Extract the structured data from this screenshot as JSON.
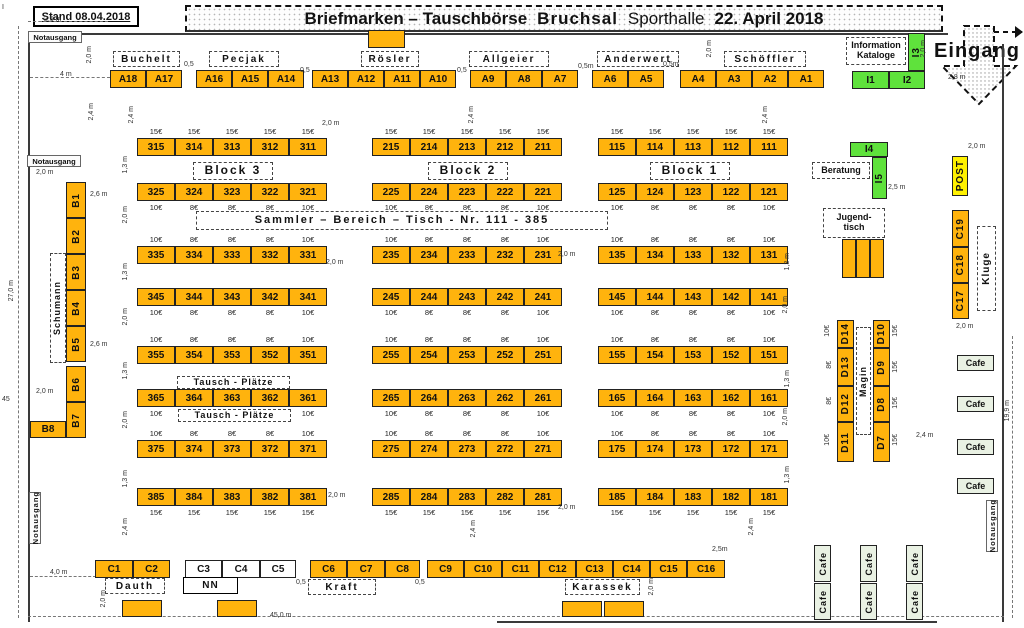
{
  "header": {
    "stand": "Stand 08.04.2018",
    "title_1": "Briefmarken – Tauschbörse",
    "title_2": "Bruchsal",
    "title_3": "Sporthalle",
    "title_4": "22. April 2018"
  },
  "entrance": {
    "label": "Eingang"
  },
  "colors": {
    "orange": "#FFB30D",
    "green": "#5FE23C",
    "yellow": "#FFF100",
    "cafe": "#E9F1E3",
    "white": "#FFFFFF"
  },
  "grid": {
    "col_x": [
      137,
      372,
      598
    ],
    "tw": 38,
    "th": 18,
    "rows": [
      {
        "y": 138,
        "pp": "above",
        "prices": [
          "15€",
          "15€",
          "15€",
          "15€",
          "15€"
        ],
        "cells": [
          [
            "315",
            "314",
            "313",
            "312",
            "311"
          ],
          [
            "215",
            "214",
            "213",
            "212",
            "211"
          ],
          [
            "115",
            "114",
            "113",
            "112",
            "111"
          ]
        ]
      },
      {
        "y": 183,
        "pp": "below",
        "prices": [
          "10€",
          "8€",
          "8€",
          "8€",
          "10€"
        ],
        "cells": [
          [
            "325",
            "324",
            "323",
            "322",
            "321"
          ],
          [
            "225",
            "224",
            "223",
            "222",
            "221"
          ],
          [
            "125",
            "124",
            "123",
            "122",
            "121"
          ]
        ]
      },
      {
        "y": 246,
        "pp": "above",
        "prices": [
          "10€",
          "8€",
          "8€",
          "8€",
          "10€"
        ],
        "cells": [
          [
            "335",
            "334",
            "333",
            "332",
            "331"
          ],
          [
            "235",
            "234",
            "233",
            "232",
            "231"
          ],
          [
            "135",
            "134",
            "133",
            "132",
            "131"
          ]
        ]
      },
      {
        "y": 288,
        "pp": "below",
        "prices": [
          "10€",
          "8€",
          "8€",
          "8€",
          "10€"
        ],
        "cells": [
          [
            "345",
            "344",
            "343",
            "342",
            "341"
          ],
          [
            "245",
            "244",
            "243",
            "242",
            "241"
          ],
          [
            "145",
            "144",
            "143",
            "142",
            "141"
          ]
        ]
      },
      {
        "y": 346,
        "pp": "above",
        "prices": [
          "10€",
          "8€",
          "8€",
          "8€",
          "10€"
        ],
        "cells": [
          [
            "355",
            "354",
            "353",
            "352",
            "351"
          ],
          [
            "255",
            "254",
            "253",
            "252",
            "251"
          ],
          [
            "155",
            "154",
            "153",
            "152",
            "151"
          ]
        ]
      },
      {
        "y": 389,
        "pp": "below",
        "prices": [
          "10€",
          "8€",
          "8€",
          "8€",
          "10€"
        ],
        "cells": [
          [
            "365",
            "364",
            "363",
            "362",
            "361"
          ],
          [
            "265",
            "264",
            "263",
            "262",
            "261"
          ],
          [
            "165",
            "164",
            "163",
            "162",
            "161"
          ]
        ]
      },
      {
        "y": 440,
        "pp": "above",
        "prices": [
          "10€",
          "8€",
          "8€",
          "8€",
          "10€"
        ],
        "cells": [
          [
            "375",
            "374",
            "373",
            "372",
            "371"
          ],
          [
            "275",
            "274",
            "273",
            "272",
            "271"
          ],
          [
            "175",
            "174",
            "173",
            "172",
            "171"
          ]
        ]
      },
      {
        "y": 488,
        "pp": "below",
        "prices": [
          "15€",
          "15€",
          "15€",
          "15€",
          "15€"
        ],
        "cells": [
          [
            "385",
            "384",
            "383",
            "382",
            "381"
          ],
          [
            "285",
            "284",
            "283",
            "282",
            "281"
          ],
          [
            "185",
            "184",
            "183",
            "182",
            "181"
          ]
        ]
      }
    ]
  },
  "tables": [
    {
      "id": "A18",
      "x": 110,
      "y": 70
    },
    {
      "id": "A17",
      "x": 146,
      "y": 70
    },
    {
      "id": "A16",
      "x": 196,
      "y": 70
    },
    {
      "id": "A15",
      "x": 232,
      "y": 70
    },
    {
      "id": "A14",
      "x": 268,
      "y": 70
    },
    {
      "id": "A13",
      "x": 312,
      "y": 70
    },
    {
      "id": "A12",
      "x": 348,
      "y": 70
    },
    {
      "id": "A11",
      "x": 384,
      "y": 70
    },
    {
      "id": "A10",
      "x": 420,
      "y": 70
    },
    {
      "id": "A9",
      "x": 470,
      "y": 70
    },
    {
      "id": "A8",
      "x": 506,
      "y": 70
    },
    {
      "id": "A7",
      "x": 542,
      "y": 70
    },
    {
      "id": "A6",
      "x": 592,
      "y": 70
    },
    {
      "id": "A5",
      "x": 628,
      "y": 70
    },
    {
      "id": "A4",
      "x": 680,
      "y": 70
    },
    {
      "id": "A3",
      "x": 716,
      "y": 70
    },
    {
      "id": "A2",
      "x": 752,
      "y": 70
    },
    {
      "id": "A1",
      "x": 788,
      "y": 70
    },
    {
      "id": "",
      "x": 368,
      "y": 30,
      "w": 37,
      "h": 18
    },
    {
      "id": "B1",
      "x": 66,
      "y": 182,
      "w": 20,
      "h": 36,
      "v": 1
    },
    {
      "id": "B2",
      "x": 66,
      "y": 218,
      "w": 20,
      "h": 36,
      "v": 1
    },
    {
      "id": "B3",
      "x": 66,
      "y": 254,
      "w": 20,
      "h": 36,
      "v": 1
    },
    {
      "id": "B4",
      "x": 66,
      "y": 290,
      "w": 20,
      "h": 36,
      "v": 1
    },
    {
      "id": "B5",
      "x": 66,
      "y": 326,
      "w": 20,
      "h": 36,
      "v": 1
    },
    {
      "id": "B6",
      "x": 66,
      "y": 366,
      "w": 20,
      "h": 36,
      "v": 1
    },
    {
      "id": "B7",
      "x": 66,
      "y": 402,
      "w": 20,
      "h": 36,
      "v": 1
    },
    {
      "id": "B8",
      "x": 30,
      "y": 421,
      "w": 36,
      "h": 17
    },
    {
      "id": "C1",
      "x": 95,
      "y": 560,
      "w": 38
    },
    {
      "id": "C2",
      "x": 133,
      "y": 560,
      "w": 37
    },
    {
      "id": "C3",
      "x": 185,
      "y": 560,
      "w": 37,
      "f": "white"
    },
    {
      "id": "C4",
      "x": 222,
      "y": 560,
      "w": 38,
      "f": "white"
    },
    {
      "id": "C5",
      "x": 260,
      "y": 560,
      "w": 36,
      "f": "white"
    },
    {
      "id": "C6",
      "x": 310,
      "y": 560,
      "w": 37
    },
    {
      "id": "C7",
      "x": 347,
      "y": 560,
      "w": 38
    },
    {
      "id": "C8",
      "x": 385,
      "y": 560,
      "w": 35
    },
    {
      "id": "C9",
      "x": 427,
      "y": 560,
      "w": 37
    },
    {
      "id": "C10",
      "x": 464,
      "y": 560,
      "w": 38
    },
    {
      "id": "C11",
      "x": 502,
      "y": 560,
      "w": 37
    },
    {
      "id": "C12",
      "x": 539,
      "y": 560,
      "w": 37
    },
    {
      "id": "C13",
      "x": 576,
      "y": 560,
      "w": 37
    },
    {
      "id": "C14",
      "x": 613,
      "y": 560,
      "w": 37
    },
    {
      "id": "C15",
      "x": 650,
      "y": 560,
      "w": 37
    },
    {
      "id": "C16",
      "x": 687,
      "y": 560,
      "w": 38
    },
    {
      "id": "C19",
      "x": 952,
      "y": 210,
      "w": 17,
      "h": 37,
      "v": 1
    },
    {
      "id": "C18",
      "x": 952,
      "y": 247,
      "w": 17,
      "h": 36,
      "v": 1
    },
    {
      "id": "C17",
      "x": 952,
      "y": 283,
      "w": 17,
      "h": 36,
      "v": 1
    },
    {
      "id": "POST",
      "x": 952,
      "y": 156,
      "w": 16,
      "h": 40,
      "f": "yellow",
      "v": 1
    },
    {
      "id": "I1",
      "x": 852,
      "y": 71,
      "w": 37,
      "f": "green"
    },
    {
      "id": "I2",
      "x": 889,
      "y": 71,
      "w": 36,
      "f": "green"
    },
    {
      "id": "I3",
      "x": 908,
      "y": 33,
      "w": 17,
      "h": 38,
      "f": "green",
      "v": 1
    },
    {
      "id": "I4",
      "x": 850,
      "y": 142,
      "w": 38,
      "h": 15,
      "f": "green"
    },
    {
      "id": "I5",
      "x": 872,
      "y": 157,
      "w": 15,
      "h": 42,
      "f": "green",
      "v": 1
    },
    {
      "id": "",
      "x": 842,
      "y": 239,
      "w": 14,
      "h": 39
    },
    {
      "id": "",
      "x": 856,
      "y": 239,
      "w": 14,
      "h": 39
    },
    {
      "id": "",
      "x": 870,
      "y": 239,
      "w": 14,
      "h": 39
    },
    {
      "id": "D14",
      "x": 837,
      "y": 320,
      "w": 17,
      "h": 28,
      "v": 1
    },
    {
      "id": "D13",
      "x": 837,
      "y": 348,
      "w": 17,
      "h": 38,
      "v": 1
    },
    {
      "id": "D12",
      "x": 837,
      "y": 386,
      "w": 17,
      "h": 36,
      "v": 1
    },
    {
      "id": "D11",
      "x": 837,
      "y": 422,
      "w": 17,
      "h": 40,
      "v": 1
    },
    {
      "id": "D10",
      "x": 873,
      "y": 320,
      "w": 17,
      "h": 28,
      "v": 1
    },
    {
      "id": "D9",
      "x": 873,
      "y": 348,
      "w": 17,
      "h": 38,
      "v": 1
    },
    {
      "id": "D8",
      "x": 873,
      "y": 386,
      "w": 17,
      "h": 36,
      "v": 1
    },
    {
      "id": "D7",
      "x": 873,
      "y": 422,
      "w": 17,
      "h": 40,
      "v": 1
    },
    {
      "id": "",
      "x": 122,
      "y": 600,
      "w": 40,
      "h": 17
    },
    {
      "id": "",
      "x": 217,
      "y": 600,
      "w": 40,
      "h": 17
    },
    {
      "id": "",
      "x": 562,
      "y": 601,
      "w": 40,
      "h": 16
    },
    {
      "id": "",
      "x": 604,
      "y": 601,
      "w": 40,
      "h": 16
    }
  ],
  "cafes": [
    {
      "t": "Cafe",
      "x": 957,
      "y": 355,
      "w": 37,
      "h": 16
    },
    {
      "t": "Cafe",
      "x": 957,
      "y": 396,
      "w": 37,
      "h": 16
    },
    {
      "t": "Cafe",
      "x": 957,
      "y": 439,
      "w": 37,
      "h": 16
    },
    {
      "t": "Cafe",
      "x": 957,
      "y": 478,
      "w": 37,
      "h": 16
    },
    {
      "t": "Cafe",
      "x": 814,
      "y": 545,
      "w": 17,
      "h": 37,
      "v": 1
    },
    {
      "t": "Cafe",
      "x": 814,
      "y": 583,
      "w": 17,
      "h": 37,
      "v": 1
    },
    {
      "t": "Cafe",
      "x": 860,
      "y": 545,
      "w": 17,
      "h": 37,
      "v": 1
    },
    {
      "t": "Cafe",
      "x": 860,
      "y": 583,
      "w": 17,
      "h": 37,
      "v": 1
    },
    {
      "t": "Cafe",
      "x": 906,
      "y": 545,
      "w": 17,
      "h": 37,
      "v": 1
    },
    {
      "t": "Cafe",
      "x": 906,
      "y": 583,
      "w": 17,
      "h": 37,
      "v": 1
    }
  ],
  "labels": [
    {
      "t": "Buchelt",
      "x": 113,
      "y": 51,
      "w": 67,
      "h": 16
    },
    {
      "t": "Pecjak",
      "x": 209,
      "y": 51,
      "w": 70,
      "h": 16
    },
    {
      "t": "Rösler",
      "x": 361,
      "y": 51,
      "w": 58,
      "h": 16
    },
    {
      "t": "Allgeier",
      "x": 469,
      "y": 51,
      "w": 80,
      "h": 16
    },
    {
      "t": "Anderwert",
      "x": 597,
      "y": 51,
      "w": 82,
      "h": 16
    },
    {
      "t": "Schöffler",
      "x": 724,
      "y": 51,
      "w": 82,
      "h": 16
    },
    {
      "t": "Block 3",
      "x": 193,
      "y": 162,
      "w": 80,
      "h": 18,
      "fs": 12
    },
    {
      "t": "Block 2",
      "x": 428,
      "y": 162,
      "w": 80,
      "h": 18,
      "fs": 12
    },
    {
      "t": "Block 1",
      "x": 650,
      "y": 162,
      "w": 80,
      "h": 18,
      "fs": 12
    },
    {
      "t": "Sammler – Bereich  –  Tisch - Nr. 111 - 385",
      "x": 196,
      "y": 211,
      "w": 412,
      "h": 19,
      "fs": 11
    },
    {
      "t": "Tausch - Plätze",
      "x": 177,
      "y": 376,
      "w": 113,
      "h": 13,
      "fs": 9,
      "ls": 1
    },
    {
      "t": "Tausch - Plätze",
      "x": 178,
      "y": 409,
      "w": 113,
      "h": 13,
      "fs": 9,
      "ls": 1
    },
    {
      "t": "Schumann",
      "x": 50,
      "y": 253,
      "w": 16,
      "h": 110,
      "v": 1,
      "fs": 9
    },
    {
      "t": "Kluge",
      "x": 977,
      "y": 226,
      "w": 19,
      "h": 85,
      "v": 1,
      "fs": 10
    },
    {
      "t": "Magin",
      "x": 856,
      "y": 327,
      "w": 15,
      "h": 108,
      "v": 1,
      "fs": 9
    },
    {
      "t": "Jugend-\ntisch",
      "x": 823,
      "y": 208,
      "w": 62,
      "h": 30,
      "fs": 9,
      "ls": 0
    },
    {
      "t": "Information\nKataloge",
      "x": 846,
      "y": 37,
      "w": 60,
      "h": 28,
      "fs": 9,
      "ls": 0
    },
    {
      "t": "Beratung",
      "x": 812,
      "y": 162,
      "w": 58,
      "h": 17,
      "fs": 9,
      "ls": 0
    },
    {
      "t": "Dauth",
      "x": 105,
      "y": 578,
      "w": 60,
      "h": 16
    },
    {
      "t": "NN",
      "x": 183,
      "y": 577,
      "w": 55,
      "h": 17,
      "solid": 1
    },
    {
      "t": "Kraft",
      "x": 308,
      "y": 579,
      "w": 68,
      "h": 16
    },
    {
      "t": "Karassek",
      "x": 565,
      "y": 579,
      "w": 75,
      "h": 16
    }
  ],
  "exits": [
    {
      "t": "Notausgang",
      "x": 28,
      "y": 31,
      "w": 54,
      "h": 12
    },
    {
      "t": "Notausgang",
      "x": 27,
      "y": 155,
      "w": 54,
      "h": 12
    },
    {
      "t": "Notausgang",
      "x": 29,
      "y": 492,
      "w": 12,
      "h": 52,
      "v": 1
    },
    {
      "t": "Notausgang",
      "x": 986,
      "y": 500,
      "w": 12,
      "h": 52,
      "v": 1
    }
  ],
  "d_prices": [
    {
      "t": "10€",
      "x": 824,
      "y": 325,
      "r": 1
    },
    {
      "t": "8€",
      "x": 826,
      "y": 361,
      "r": 1
    },
    {
      "t": "8€",
      "x": 826,
      "y": 397,
      "r": 1
    },
    {
      "t": "10€",
      "x": 824,
      "y": 434,
      "r": 1
    },
    {
      "t": "15€",
      "x": 892,
      "y": 325,
      "r": 1
    },
    {
      "t": "15€",
      "x": 892,
      "y": 361,
      "r": 1
    },
    {
      "t": "15€",
      "x": 892,
      "y": 397,
      "r": 1
    },
    {
      "t": "15€",
      "x": 892,
      "y": 434,
      "r": 1
    }
  ],
  "dims": [
    {
      "t": "I",
      "x": 2,
      "y": 4
    },
    {
      "t": "2,5 m",
      "x": 44,
      "y": 16
    },
    {
      "t": "4 m",
      "x": 60,
      "y": 71
    },
    {
      "t": "2,0 m",
      "x": 86,
      "y": 46,
      "r": 1
    },
    {
      "t": "2,4 m",
      "x": 88,
      "y": 103,
      "r": 1
    },
    {
      "t": "27,0 m",
      "x": 8,
      "y": 280,
      "r": 1
    },
    {
      "t": "45",
      "x": 2,
      "y": 396
    },
    {
      "t": "2,0 m",
      "x": 36,
      "y": 169
    },
    {
      "t": "2,6 m",
      "x": 90,
      "y": 191
    },
    {
      "t": "2,6 m",
      "x": 90,
      "y": 341
    },
    {
      "t": "2,0 m",
      "x": 36,
      "y": 388
    },
    {
      "t": "4,0 m",
      "x": 50,
      "y": 569
    },
    {
      "t": "45,0 m",
      "x": 270,
      "y": 612
    },
    {
      "t": "2,4 m",
      "x": 128,
      "y": 106,
      "r": 1
    },
    {
      "t": "1,3 m",
      "x": 122,
      "y": 156,
      "r": 1
    },
    {
      "t": "2,0 m",
      "x": 122,
      "y": 206,
      "r": 1
    },
    {
      "t": "2,0 m",
      "x": 322,
      "y": 120
    },
    {
      "t": "2,4 m",
      "x": 468,
      "y": 106,
      "r": 1
    },
    {
      "t": "2,4 m",
      "x": 762,
      "y": 106,
      "r": 1
    },
    {
      "t": "2,0 m",
      "x": 326,
      "y": 259
    },
    {
      "t": "2,0 m",
      "x": 558,
      "y": 251
    },
    {
      "t": "1,3 m",
      "x": 122,
      "y": 263,
      "r": 1
    },
    {
      "t": "2,0 m",
      "x": 122,
      "y": 308,
      "r": 1
    },
    {
      "t": "1,3 m",
      "x": 122,
      "y": 362,
      "r": 1
    },
    {
      "t": "2,0 m",
      "x": 122,
      "y": 411,
      "r": 1
    },
    {
      "t": "1,3 m",
      "x": 122,
      "y": 470,
      "r": 1
    },
    {
      "t": "2,4 m",
      "x": 122,
      "y": 518,
      "r": 1
    },
    {
      "t": "2,0 m",
      "x": 328,
      "y": 492
    },
    {
      "t": "2,4 m",
      "x": 470,
      "y": 520,
      "r": 1
    },
    {
      "t": "2,0 m",
      "x": 558,
      "y": 504
    },
    {
      "t": "1,3 m",
      "x": 784,
      "y": 253,
      "r": 1
    },
    {
      "t": "2,0 m",
      "x": 782,
      "y": 296,
      "r": 1
    },
    {
      "t": "1,3 m",
      "x": 784,
      "y": 370,
      "r": 1
    },
    {
      "t": "2,0 m",
      "x": 782,
      "y": 408,
      "r": 1
    },
    {
      "t": "1,3 m",
      "x": 784,
      "y": 466,
      "r": 1
    },
    {
      "t": "2,4 m",
      "x": 748,
      "y": 518,
      "r": 1
    },
    {
      "t": "2,0 m",
      "x": 706,
      "y": 40,
      "r": 1
    },
    {
      "t": "2,0 m",
      "x": 920,
      "y": 40,
      "r": 1
    },
    {
      "t": "0,5",
      "x": 184,
      "y": 61
    },
    {
      "t": "0,5",
      "x": 300,
      "y": 67
    },
    {
      "t": "0,5",
      "x": 457,
      "y": 67
    },
    {
      "t": "0,5m",
      "x": 578,
      "y": 63
    },
    {
      "t": "0,5m",
      "x": 663,
      "y": 61
    },
    {
      "t": "0,5",
      "x": 296,
      "y": 579
    },
    {
      "t": "0,5",
      "x": 415,
      "y": 579
    },
    {
      "t": "2,8 m",
      "x": 948,
      "y": 74
    },
    {
      "t": "2,0 m",
      "x": 968,
      "y": 143
    },
    {
      "t": "2,5 m",
      "x": 888,
      "y": 184
    },
    {
      "t": "2,0 m",
      "x": 956,
      "y": 323
    },
    {
      "t": "19,9 m",
      "x": 1004,
      "y": 400,
      "r": 1
    },
    {
      "t": "2,4 m",
      "x": 916,
      "y": 432
    },
    {
      "t": "2,5m",
      "x": 712,
      "y": 546
    },
    {
      "t": "2,0 m",
      "x": 648,
      "y": 578,
      "r": 1
    },
    {
      "t": "2,0 m",
      "x": 100,
      "y": 590,
      "r": 1
    }
  ],
  "walls": [
    {
      "x": 28,
      "y": 33,
      "w": 920,
      "h": 2
    },
    {
      "x": 28,
      "y": 33,
      "w": 2,
      "h": 589
    },
    {
      "x": 1002,
      "y": 44,
      "w": 2,
      "h": 578
    },
    {
      "x": 497,
      "y": 621,
      "w": 440,
      "h": 2
    }
  ],
  "dashes": [
    {
      "x": 18,
      "y": 26,
      "h": 592
    },
    {
      "x": 28,
      "y": 616,
      "w": 976
    },
    {
      "x": 1012,
      "y": 336,
      "h": 282
    },
    {
      "x": 28,
      "y": 21,
      "w": 80
    },
    {
      "x": 30,
      "y": 77,
      "w": 80
    },
    {
      "x": 30,
      "y": 576,
      "w": 66
    }
  ]
}
